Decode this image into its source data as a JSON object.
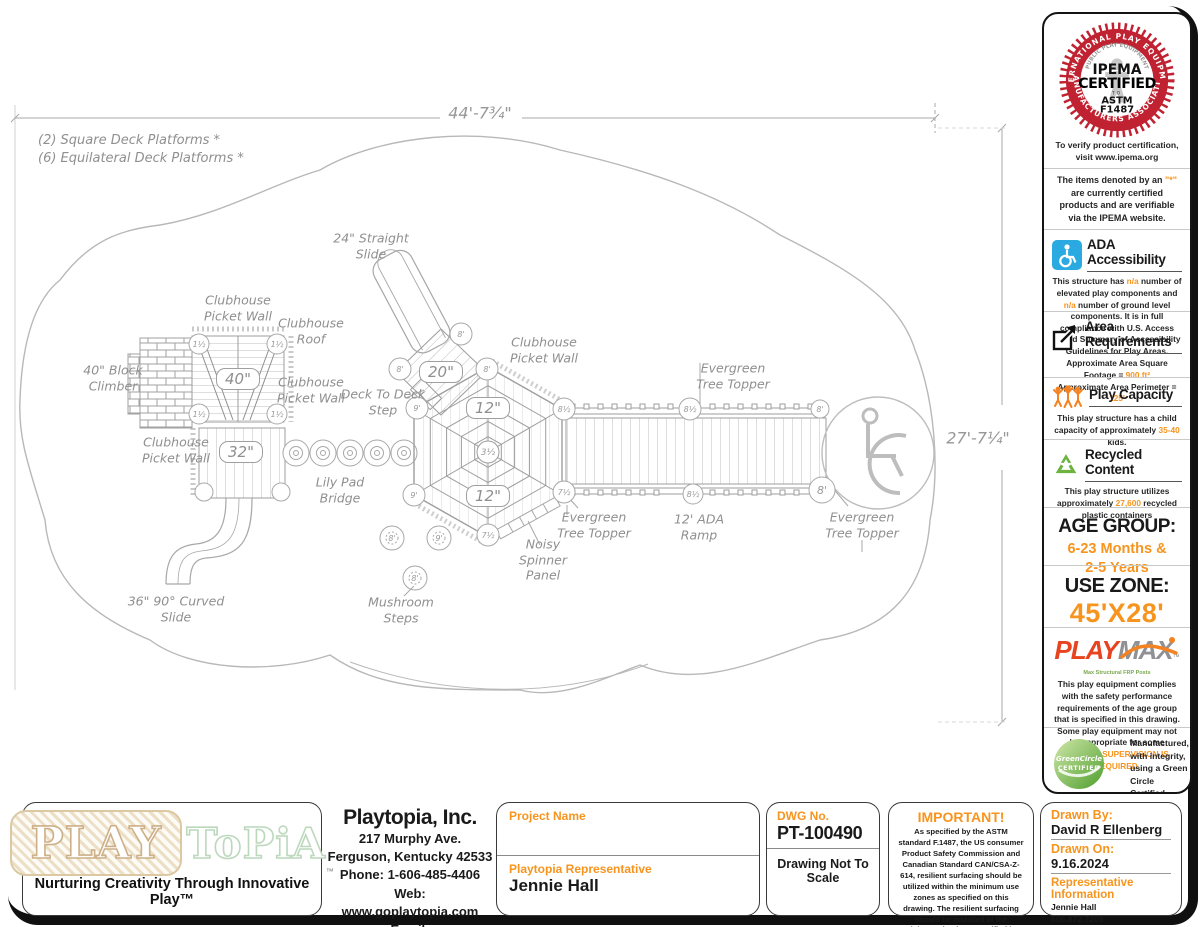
{
  "drawing": {
    "notes": {
      "n1": "(2) Square Deck Platforms *",
      "n2": "(6) Equilateral Deck Platforms *"
    },
    "dims": {
      "width": "44'-7¾\"",
      "height": "27'-7¼\""
    },
    "labels": {
      "straight_slide": "24\" Straight Slide",
      "picket_wall": "Clubhouse Picket Wall",
      "roof": "Clubhouse Roof",
      "block_climber": "40\" Block Climber",
      "deck_step": "Deck To Deck Step",
      "lily_pad": "Lily Pad Bridge",
      "curved_slide": "36\" 90° Curved Slide",
      "mushroom": "Mushroom Steps",
      "spinner": "Noisy Spinner Panel",
      "evergreen": "Evergreen Tree Topper",
      "ramp": "12' ADA Ramp"
    },
    "decks": {
      "d40": "40\"",
      "d32": "32\"",
      "d20": "20\"",
      "d12": "12\""
    },
    "markers": {
      "m1h": "1½",
      "m3h": "3½",
      "m7h": "7½",
      "m8": "8'",
      "m8h": "8½",
      "m9": "9'"
    }
  },
  "sidebar": {
    "ipema": {
      "arc_top": "INTERNATIONAL PLAY EQUIPMENT",
      "arc_bottom": "MANUFACTURERS ASSOCIATION",
      "arc_inner": "PUBLIC PLAY EQUIPMENT",
      "name": "IPEMA",
      "certified": "CERTIFIED",
      "to": "TO",
      "astm": "ASTM",
      "code": "F1487",
      "verify": "To verify product certification, visit www.ipema.org"
    },
    "ipema_note": {
      "pre": "The items denoted by an ",
      "star": "\"*\"",
      "post": " are currently certified products and are verifiable via the IPEMA website."
    },
    "ada": {
      "title": "ADA Accessibility",
      "p1": "This structure has ",
      "v1": "n/a",
      "p2": " number of elevated play components and ",
      "v2": "n/a",
      "p3": " number of ground level components. It is in full compliance with U.S. Access Board Summary of Accessibility Guidelines for Play Areas."
    },
    "area": {
      "title": "Area Requirements",
      "l1": "Approximate Area Square Footage = ",
      "v1": "900 ft²",
      "l2": "Approximate Area Perimeter = ",
      "v2": "125'"
    },
    "capacity": {
      "title": "Play Capacity",
      "p1": "This play structure has a child capacity of approximately ",
      "v1": "35-40",
      "p2": " kids."
    },
    "recycled": {
      "title": "Recycled Content",
      "p1": "This play structure utilizes approximately ",
      "v1": "27,600",
      "p2": " recycled plastic containers"
    },
    "age": {
      "title": "AGE GROUP:",
      "l1": "6-23 Months &",
      "l2": "2-5 Years"
    },
    "use_zone": {
      "title": "USE ZONE:",
      "value": "45'X28'"
    },
    "playmax": {
      "play": "PLAY",
      "max": "MAX",
      "tm": "™",
      "tagline": "Max Structural FRP Posts",
      "p1": "This play equipment complies with the safety performance requirements of the age group that is specified in this drawing. Some play equipment may not be appropriate for some children. ",
      "warn": "SUPERVISION IS REQUIRED."
    },
    "green": {
      "badge_line1": "GreenCircle",
      "badge_line2": "CERTIFIED",
      "text": "Manufactured, with integrity, using a Green Circle Certified Product",
      "brand1": "POLY'TUF",
      "brand2a": "POLY",
      "brand2b": "FORCE"
    }
  },
  "footer": {
    "logo": {
      "play": "PLAY",
      "topia": "ToPiA",
      "tm": "™",
      "tagline": "Nurturing Creativity Through Innovative Play™"
    },
    "company": {
      "name": "Playtopia, Inc.",
      "addr1": "217 Murphy Ave.",
      "addr2": "Ferguson, Kentucky 42533",
      "phone": "Phone: 1-606-485-4406",
      "web": "Web: www.goplaytopia.com",
      "email": "Email: info@goplaytopia.com"
    },
    "project": {
      "label": "Project Name",
      "value": "",
      "rep_label": "Playtopia Representative",
      "rep_value": "Jennie Hall"
    },
    "dwg": {
      "label": "DWG No.",
      "number": "PT-100490",
      "scale": "Drawing Not To Scale"
    },
    "important": {
      "title": "IMPORTANT!",
      "body": "As specified by the ASTM standard F.1487, the US consumer Product Safety Commission and Canadian Standard CAN/CSA-Z-614, resilient surfacing should be utilized within the minimum use zones as specified on this drawing. The resilient surfacing should be installed at the minimum depth as specified by the standards to meet critical fall height requirements."
    },
    "drawn": {
      "by_label": "Drawn By:",
      "by_value": "David R Ellenberg",
      "on_label": "Drawn On:",
      "on_value": "9.16.2024",
      "rep_label": "Representative Information",
      "rep_name": "Jennie Hall",
      "rep_phone": "606.872.7209",
      "rep_email": "jennie@goplaytopia.com",
      "rep_web": "www.goplaytopia.com"
    }
  }
}
